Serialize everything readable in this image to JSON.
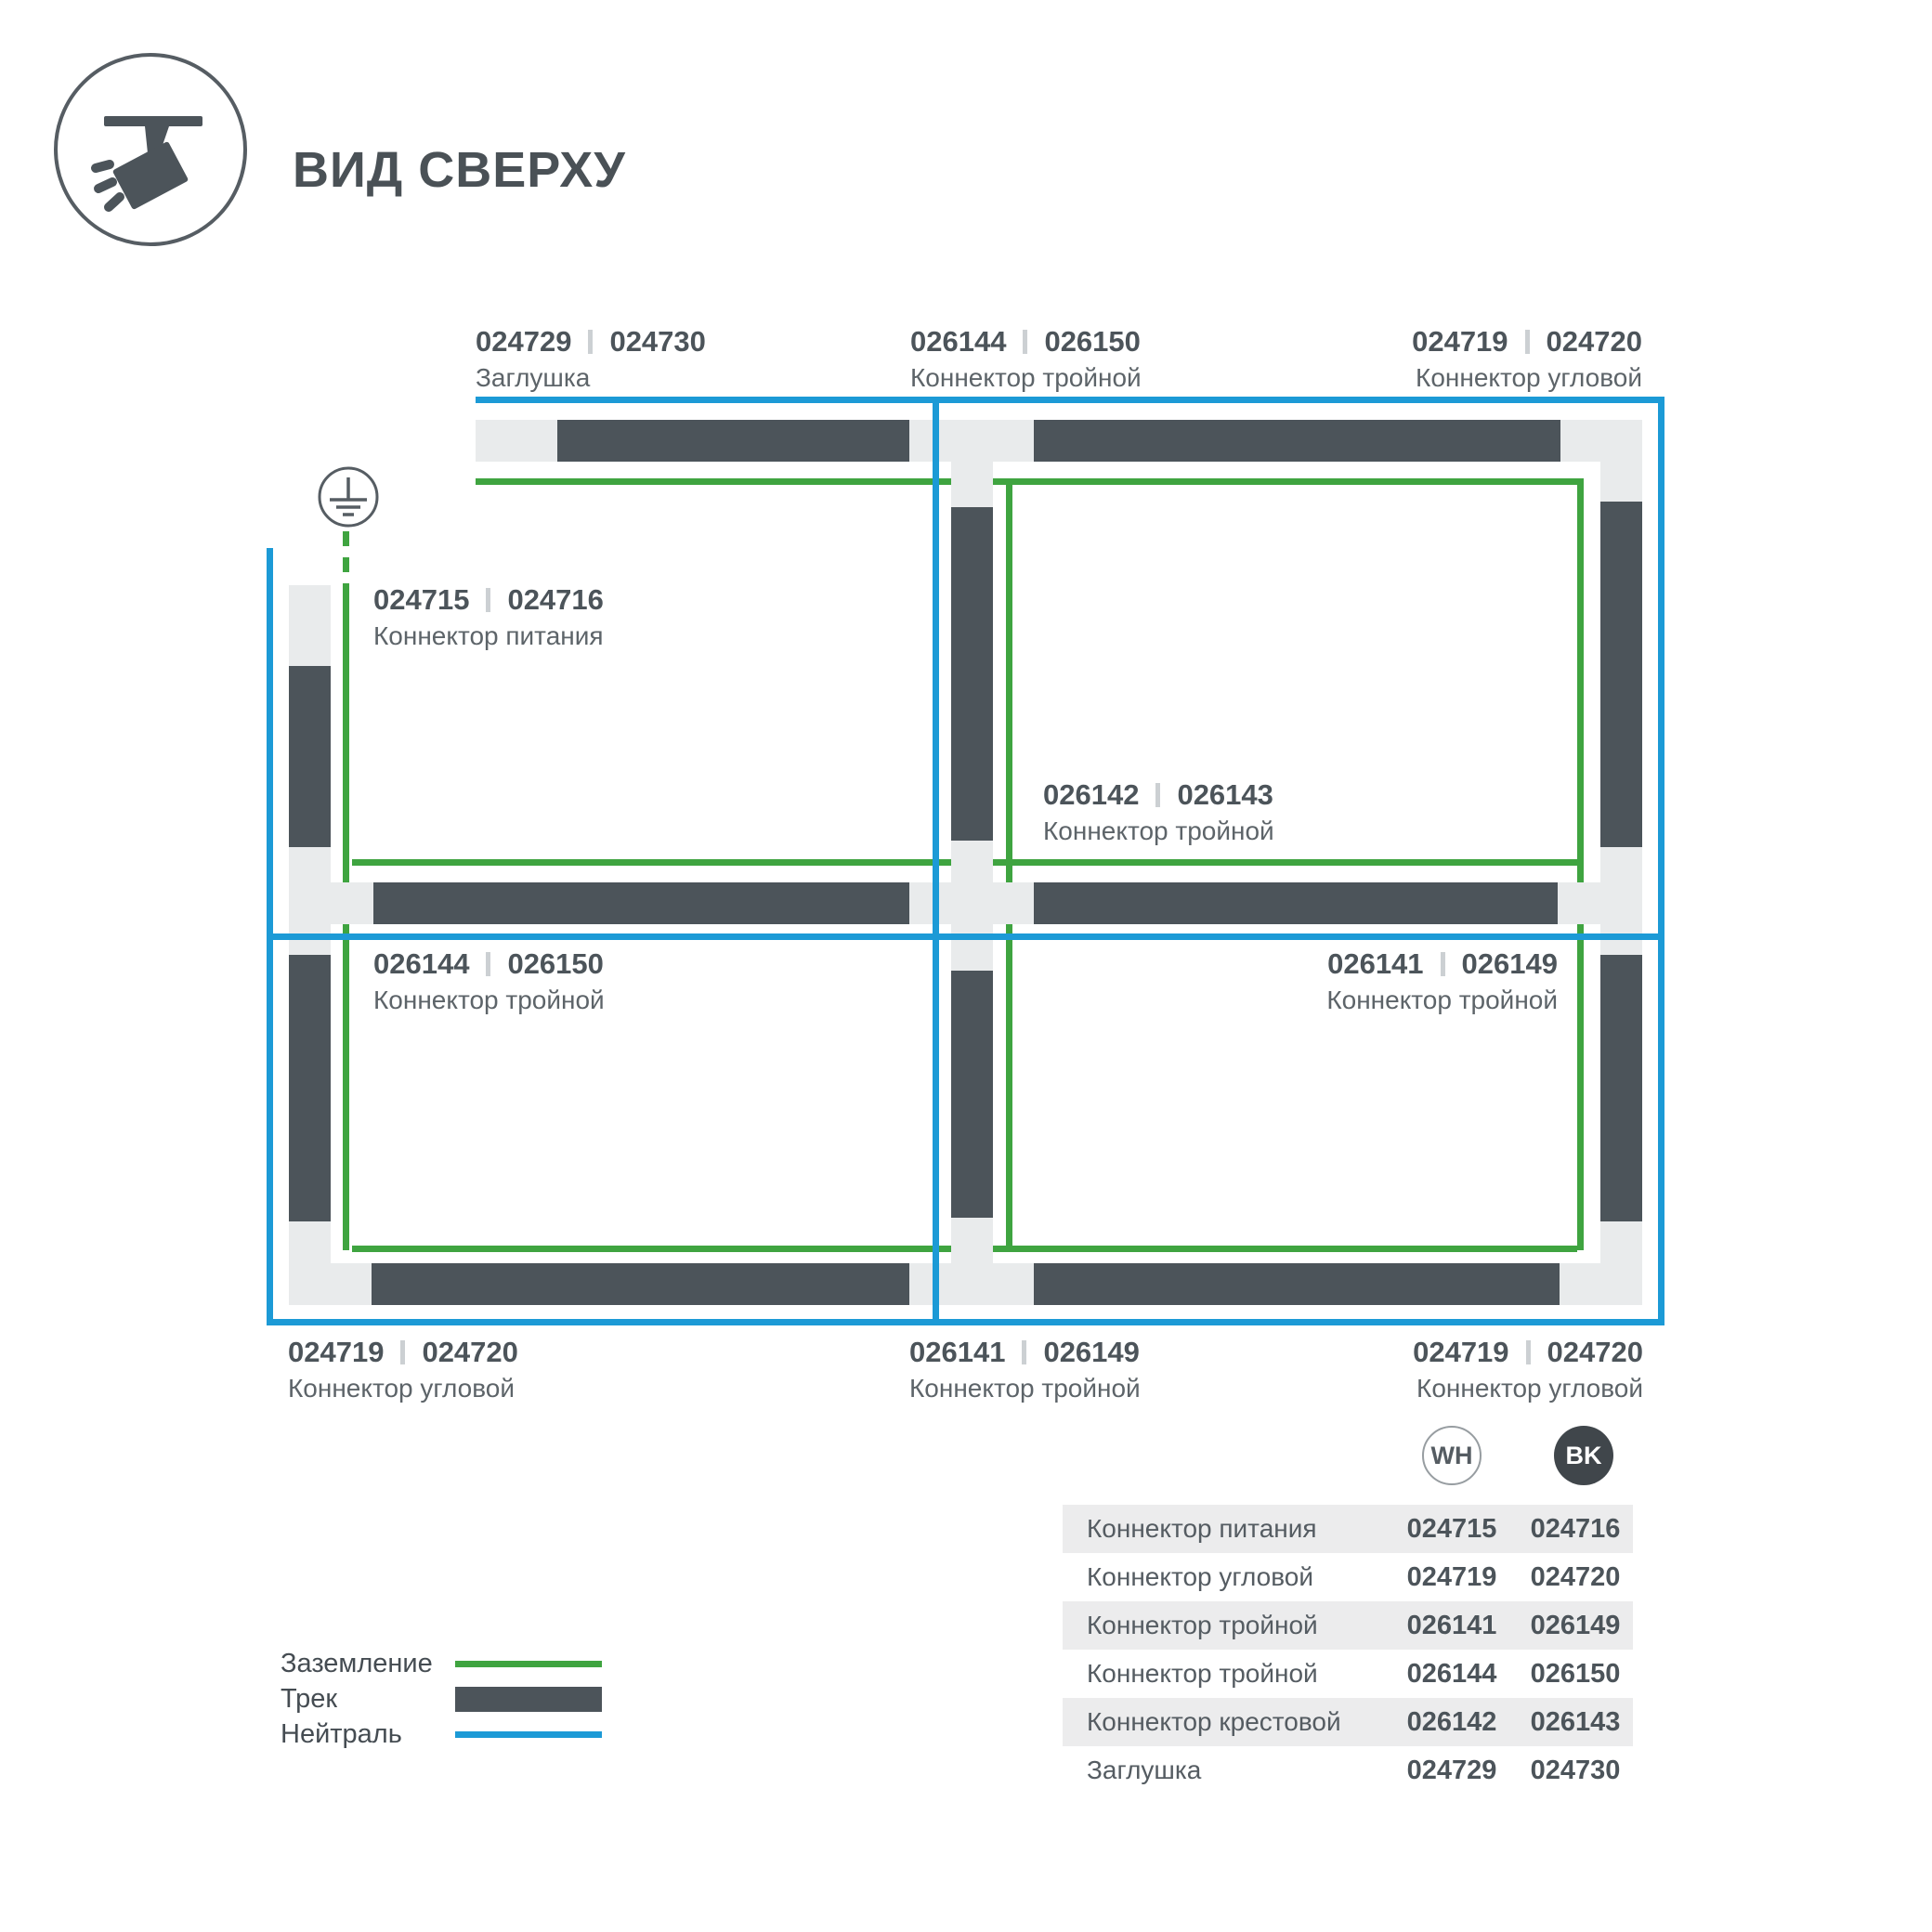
{
  "header": {
    "title": "ВИД СВЕРХУ"
  },
  "colors": {
    "track": "#4c545a",
    "connector_light": "#e9ebec",
    "ground_green": "#3fa440",
    "neutral_blue": "#1c9ad6",
    "table_row_alt": "#ececed",
    "bk_badge": "#40464b"
  },
  "diagram": {
    "labels": [
      {
        "wh": "024729",
        "bk": "024730",
        "name": "Заглушка"
      },
      {
        "wh": "026144",
        "bk": "026150",
        "name": "Коннектор тройной"
      },
      {
        "wh": "024719",
        "bk": "024720",
        "name": "Коннектор угловой"
      },
      {
        "wh": "024715",
        "bk": "024716",
        "name": "Коннектор питания"
      },
      {
        "wh": "026142",
        "bk": "026143",
        "name": "Коннектор тройной"
      },
      {
        "wh": "026144",
        "bk": "026150",
        "name": "Коннектор тройной"
      },
      {
        "wh": "026141",
        "bk": "026149",
        "name": "Коннектор тройной"
      },
      {
        "wh": "024719",
        "bk": "024720",
        "name": "Коннектор угловой"
      },
      {
        "wh": "026141",
        "bk": "026149",
        "name": "Коннектор тройной"
      },
      {
        "wh": "024719",
        "bk": "024720",
        "name": "Коннектор угловой"
      }
    ]
  },
  "legend": {
    "items": [
      {
        "label": "Заземление",
        "swatch": "ground-line"
      },
      {
        "label": "Трек",
        "swatch": "track-bar"
      },
      {
        "label": "Нейтраль",
        "swatch": "neutral-line"
      }
    ]
  },
  "table": {
    "columns": {
      "wh": "WH",
      "bk": "BK"
    },
    "rows": [
      {
        "name": "Коннектор питания",
        "wh": "024715",
        "bk": "024716"
      },
      {
        "name": "Коннектор угловой",
        "wh": "024719",
        "bk": "024720"
      },
      {
        "name": "Коннектор тройной",
        "wh": "026141",
        "bk": "026149"
      },
      {
        "name": "Коннектор тройной",
        "wh": "026144",
        "bk": "026150"
      },
      {
        "name": "Коннектор крестовой",
        "wh": "026142",
        "bk": "026143"
      },
      {
        "name": "Заглушка",
        "wh": "024729",
        "bk": "024730"
      }
    ]
  }
}
